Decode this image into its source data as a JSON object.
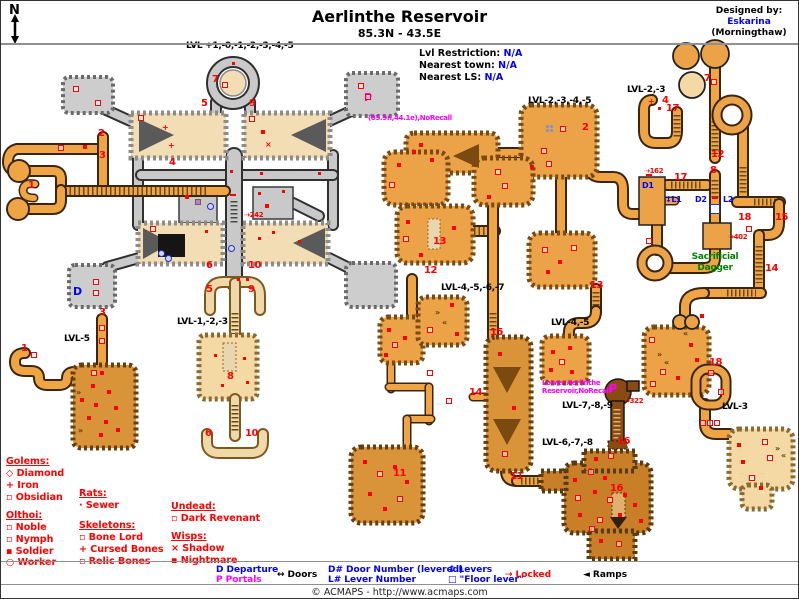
{
  "header": {
    "title": "Aerlinthe Reservoir",
    "coords": "85.3N - 43.5E",
    "compass": "N"
  },
  "designer": {
    "label": "Designed by:",
    "name": "Eskarina",
    "world": "(Morningthaw)"
  },
  "info_panel": {
    "rows": [
      [
        "Lvl Restriction:",
        "N/A"
      ],
      [
        "Nearest town:",
        "N/A"
      ],
      [
        "Nearest LS:",
        "N/A"
      ]
    ]
  },
  "footer": "© ACMAPS - http://www.acmaps.com",
  "colors": {
    "black": "#000000",
    "red": "#ff0000",
    "blue": "#0000ff",
    "magenta": "#ff00ff",
    "green": "#008000"
  },
  "creature_legend": {
    "groups": [
      {
        "title": "Golems:",
        "x": 5,
        "y": 455,
        "items": [
          [
            "◇",
            "Diamond",
            467
          ],
          [
            "+",
            "Iron",
            479
          ],
          [
            "▫",
            "Obsidian",
            491
          ]
        ]
      },
      {
        "title": "Rats:",
        "x": 78,
        "y": 487,
        "items": [
          [
            "·",
            "Sewer",
            499
          ]
        ]
      },
      {
        "title": "Olthoi:",
        "x": 5,
        "y": 509,
        "items": [
          [
            "▫",
            "Noble",
            521
          ],
          [
            "▫",
            "Nymph",
            533
          ],
          [
            "▪",
            "Soldier",
            545
          ],
          [
            "○",
            "Worker",
            556
          ]
        ]
      },
      {
        "title": "Skeletons:",
        "x": 78,
        "y": 519,
        "items": [
          [
            "▫",
            "Bone Lord",
            531
          ],
          [
            "+",
            "Cursed Bones",
            543
          ],
          [
            "▫",
            "Relic Bones",
            555
          ]
        ]
      },
      {
        "title": "Undead:",
        "x": 170,
        "y": 500,
        "items": [
          [
            "▫",
            "Dark Revenant",
            512
          ]
        ]
      },
      {
        "title": "Wisps:",
        "x": 170,
        "y": 530,
        "items": [
          [
            "×",
            "Shadow",
            542
          ],
          [
            "▪",
            "Nightmare",
            554
          ]
        ]
      }
    ]
  },
  "bottom_bar": {
    "items": [
      {
        "x": 215,
        "rows": [
          [
            "D",
            "Departure",
            "blue",
            "blue",
            564
          ],
          [
            "P",
            "Portals",
            "magenta",
            "magenta",
            574
          ]
        ]
      },
      {
        "x": 276,
        "rows": [
          [
            "↔",
            "Doors",
            "black",
            "black",
            569
          ]
        ]
      },
      {
        "x": 327,
        "rows": [
          [
            "D#",
            "Door Number (levered)",
            "blue",
            "blue",
            564
          ],
          [
            "L#",
            "Lever Number",
            "blue",
            "blue",
            574
          ]
        ]
      },
      {
        "x": 447,
        "rows": [
          [
            "↕",
            "Levers",
            "blue",
            "blue",
            564
          ],
          [
            "□",
            "\"Floor lever\"",
            "blue",
            "blue",
            574
          ]
        ]
      },
      {
        "x": 504,
        "rows": [
          [
            "⇢",
            "Locked",
            "red",
            "red",
            569
          ]
        ]
      },
      {
        "x": 582,
        "rows": [
          [
            "◄",
            "Ramps",
            "black",
            "black",
            569
          ]
        ]
      }
    ]
  },
  "map": {
    "labels": [
      [
        "LVL +1,-0,-1,-2,-3,-4,-5",
        185,
        40,
        "black",
        9
      ],
      [
        "LVL-2,-3,-4,-5",
        527,
        95,
        "black",
        9
      ],
      [
        "LVL-2,-3",
        626,
        84,
        "black",
        9
      ],
      [
        "LVL-1,-2,-3",
        176,
        316,
        "black",
        9
      ],
      [
        "LVL-5",
        63,
        333,
        "black",
        9
      ],
      [
        "LVL-4,-5,-6,-7",
        440,
        282,
        "black",
        9
      ],
      [
        "LVL-4,-5",
        550,
        317,
        "black",
        9
      ],
      [
        "LVL-7,-8,-9",
        561,
        400,
        "black",
        9
      ],
      [
        "LVL-6,-7,-8",
        541,
        437,
        "black",
        9
      ],
      [
        "LVL-3",
        721,
        401,
        "black",
        9
      ],
      [
        "Sacrificial",
        714,
        251,
        "green",
        9,
        "c"
      ],
      [
        "Dagger",
        714,
        262,
        "green",
        9,
        "c"
      ],
      [
        "(85.9n,44.1e),NoRecall",
        367,
        113,
        "magenta",
        7
      ],
      [
        "Lower Aerlinthe",
        541,
        378,
        "magenta",
        7
      ],
      [
        "Reservoir,NoRecall",
        541,
        386,
        "magenta",
        7
      ],
      [
        "⇢242",
        243,
        210,
        "red",
        7
      ],
      [
        "⇢162",
        643,
        166,
        "red",
        7
      ],
      [
        "⇢402",
        727,
        232,
        "red",
        7
      ],
      [
        "⇢322",
        623,
        396,
        "red",
        7
      ],
      [
        "D",
        72,
        284,
        "blue",
        11
      ],
      [
        "P",
        363,
        90,
        "magenta",
        11
      ],
      [
        "P",
        608,
        381,
        "magenta",
        11
      ],
      [
        "D1",
        641,
        180,
        "blue",
        8
      ],
      [
        "↕L1",
        664,
        194,
        "blue",
        8
      ],
      [
        "D2",
        694,
        194,
        "blue",
        8
      ],
      [
        "L2",
        722,
        194,
        "blue",
        8
      ]
    ],
    "numbers": [
      [
        "1",
        31,
        186
      ],
      [
        "1",
        24,
        349
      ],
      [
        "2",
        101,
        134
      ],
      [
        "2",
        585,
        128
      ],
      [
        "3",
        102,
        156
      ],
      [
        "3",
        102,
        313
      ],
      [
        "4",
        172,
        163
      ],
      [
        "4",
        665,
        101
      ],
      [
        "5",
        204,
        104
      ],
      [
        "5",
        209,
        290
      ],
      [
        "6",
        209,
        266
      ],
      [
        "6",
        208,
        434
      ],
      [
        "7",
        215,
        80
      ],
      [
        "7",
        707,
        79
      ],
      [
        "8",
        230,
        377
      ],
      [
        "8",
        713,
        171
      ],
      [
        "9",
        252,
        104
      ],
      [
        "9",
        251,
        290
      ],
      [
        "10",
        251,
        266
      ],
      [
        "10",
        248,
        434
      ],
      [
        "11",
        396,
        474
      ],
      [
        "11",
        513,
        477
      ],
      [
        "12",
        427,
        271
      ],
      [
        "12",
        714,
        155
      ],
      [
        "13",
        436,
        242
      ],
      [
        "13",
        593,
        286
      ],
      [
        "14",
        472,
        393
      ],
      [
        "14",
        768,
        269
      ],
      [
        "15",
        493,
        333
      ],
      [
        "15",
        778,
        218
      ],
      [
        "16",
        620,
        442
      ],
      [
        "16",
        613,
        489
      ],
      [
        "17",
        669,
        109
      ],
      [
        "17",
        677,
        178
      ],
      [
        "18",
        741,
        218
      ],
      [
        "18",
        712,
        363
      ]
    ],
    "markers": [
      [
        75,
        88,
        "o"
      ],
      [
        97,
        102,
        "o"
      ],
      [
        360,
        85,
        "o"
      ],
      [
        367,
        96,
        "o"
      ],
      [
        232,
        62,
        "dot"
      ],
      [
        224,
        84,
        "o"
      ],
      [
        165,
        127,
        "plus"
      ],
      [
        171,
        145,
        "plus"
      ],
      [
        140,
        117,
        "o"
      ],
      [
        262,
        131,
        "sq"
      ],
      [
        267,
        143,
        "x"
      ],
      [
        251,
        118,
        "o"
      ],
      [
        318,
        172,
        "dot"
      ],
      [
        282,
        190,
        "dot"
      ],
      [
        260,
        172,
        "dot"
      ],
      [
        230,
        170,
        "dot"
      ],
      [
        197,
        201,
        "pink"
      ],
      [
        209,
        205,
        "lever"
      ],
      [
        186,
        196,
        "sq"
      ],
      [
        258,
        192,
        "dot"
      ],
      [
        266,
        205,
        "sq"
      ],
      [
        152,
        228,
        "o"
      ],
      [
        205,
        230,
        "dot"
      ],
      [
        160,
        252,
        "lever"
      ],
      [
        167,
        257,
        "lever"
      ],
      [
        230,
        247,
        "lever"
      ],
      [
        258,
        237,
        "dot"
      ],
      [
        272,
        231,
        "dot"
      ],
      [
        298,
        240,
        "dot"
      ],
      [
        95,
        281,
        "o"
      ],
      [
        95,
        292,
        "o"
      ],
      [
        232,
        196,
        "door"
      ],
      [
        237,
        278,
        "dot"
      ],
      [
        246,
        278,
        "dot"
      ],
      [
        214,
        354,
        "dot"
      ],
      [
        243,
        357,
        "dot"
      ],
      [
        221,
        384,
        "dot"
      ],
      [
        246,
        381,
        "dot"
      ],
      [
        84,
        146,
        "sq"
      ],
      [
        60,
        147,
        "o"
      ],
      [
        33,
        354,
        "o"
      ],
      [
        93,
        372,
        "o"
      ],
      [
        101,
        372,
        "sq"
      ],
      [
        101,
        327,
        "o"
      ],
      [
        101,
        340,
        "o"
      ],
      [
        92,
        385,
        "sq"
      ],
      [
        108,
        391,
        "sq"
      ],
      [
        95,
        404,
        "sq"
      ],
      [
        115,
        407,
        "sq"
      ],
      [
        88,
        417,
        "sq"
      ],
      [
        105,
        421,
        "sq"
      ],
      [
        117,
        429,
        "sq"
      ],
      [
        100,
        434,
        "sq"
      ],
      [
        81,
        399,
        "sq"
      ],
      [
        78,
        391,
        "rr"
      ],
      [
        80,
        429,
        "rr"
      ],
      [
        548,
        127,
        "flower"
      ],
      [
        562,
        128,
        "o"
      ],
      [
        543,
        150,
        "o"
      ],
      [
        548,
        163,
        "o"
      ],
      [
        531,
        166,
        "sq"
      ],
      [
        420,
        144,
        "sq"
      ],
      [
        431,
        159,
        "sq"
      ],
      [
        413,
        151,
        "sq"
      ],
      [
        391,
        184,
        "o"
      ],
      [
        398,
        164,
        "sq"
      ],
      [
        497,
        171,
        "o"
      ],
      [
        504,
        185,
        "o"
      ],
      [
        488,
        196,
        "sq"
      ],
      [
        407,
        221,
        "sq"
      ],
      [
        453,
        227,
        "sq"
      ],
      [
        405,
        238,
        "o"
      ],
      [
        420,
        254,
        "sq"
      ],
      [
        544,
        249,
        "o"
      ],
      [
        559,
        261,
        "sq"
      ],
      [
        573,
        247,
        "o"
      ],
      [
        547,
        271,
        "sq"
      ],
      [
        648,
        176,
        "door"
      ],
      [
        552,
        351,
        "sq"
      ],
      [
        569,
        347,
        "sq"
      ],
      [
        561,
        361,
        "o"
      ],
      [
        550,
        369,
        "sq"
      ],
      [
        571,
        371,
        "sq"
      ],
      [
        388,
        329,
        "sq"
      ],
      [
        394,
        344,
        "o"
      ],
      [
        385,
        354,
        "sq"
      ],
      [
        404,
        337,
        "sq"
      ],
      [
        437,
        311,
        "rr"
      ],
      [
        444,
        321,
        "rl"
      ],
      [
        451,
        304,
        "sq"
      ],
      [
        429,
        329,
        "o"
      ],
      [
        456,
        333,
        "sq"
      ],
      [
        499,
        353,
        "sq"
      ],
      [
        513,
        407,
        "sq"
      ],
      [
        504,
        453,
        "o"
      ],
      [
        429,
        372,
        "o"
      ],
      [
        448,
        400,
        "o"
      ],
      [
        364,
        461,
        "sq"
      ],
      [
        379,
        473,
        "o"
      ],
      [
        394,
        466,
        "sq"
      ],
      [
        369,
        493,
        "sq"
      ],
      [
        399,
        498,
        "o"
      ],
      [
        384,
        508,
        "sq"
      ],
      [
        406,
        481,
        "sq"
      ],
      [
        574,
        479,
        "sq"
      ],
      [
        590,
        471,
        "o"
      ],
      [
        604,
        477,
        "sq"
      ],
      [
        577,
        497,
        "o"
      ],
      [
        594,
        491,
        "sq"
      ],
      [
        609,
        499,
        "o"
      ],
      [
        624,
        494,
        "sq"
      ],
      [
        579,
        514,
        "sq"
      ],
      [
        599,
        519,
        "o"
      ],
      [
        619,
        514,
        "sq"
      ],
      [
        634,
        504,
        "sq"
      ],
      [
        591,
        528,
        "o"
      ],
      [
        640,
        520,
        "sq"
      ],
      [
        600,
        540,
        "sq"
      ],
      [
        618,
        543,
        "o"
      ],
      [
        610,
        455,
        "o"
      ],
      [
        595,
        458,
        "sq"
      ],
      [
        648,
        240,
        "o"
      ],
      [
        748,
        228,
        "o"
      ],
      [
        701,
        315,
        "sq"
      ],
      [
        651,
        339,
        "o"
      ],
      [
        690,
        344,
        "sq"
      ],
      [
        662,
        371,
        "o"
      ],
      [
        677,
        377,
        "sq"
      ],
      [
        652,
        383,
        "o"
      ],
      [
        696,
        359,
        "sq"
      ],
      [
        659,
        353,
        "rr"
      ],
      [
        666,
        361,
        "rl"
      ],
      [
        685,
        332,
        "rl"
      ],
      [
        710,
        372,
        "o"
      ],
      [
        720,
        391,
        "o"
      ],
      [
        702,
        422,
        "o"
      ],
      [
        709,
        422,
        "o"
      ],
      [
        716,
        422,
        "o"
      ],
      [
        738,
        444,
        "sq"
      ],
      [
        764,
        441,
        "o"
      ],
      [
        742,
        461,
        "sq"
      ],
      [
        769,
        457,
        "o"
      ],
      [
        777,
        447,
        "rr"
      ],
      [
        783,
        454,
        "rl"
      ],
      [
        751,
        477,
        "o"
      ],
      [
        760,
        487,
        "sq"
      ],
      [
        713,
        81,
        "o"
      ],
      [
        651,
        101,
        "plus"
      ],
      [
        658,
        107,
        "dot"
      ],
      [
        714,
        208,
        "fl"
      ],
      [
        714,
        199,
        "door"
      ]
    ]
  }
}
